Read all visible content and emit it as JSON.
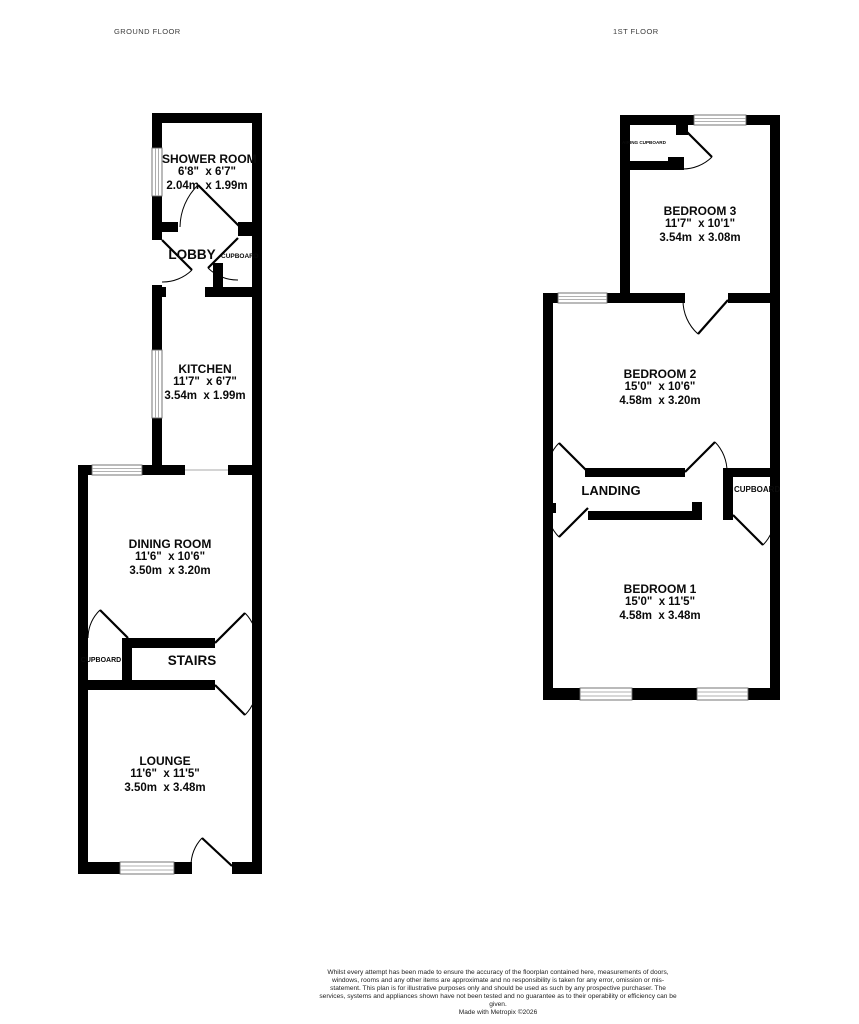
{
  "floors": [
    {
      "label": "GROUND FLOOR",
      "rooms": {
        "shower": {
          "name": "SHOWER ROOM",
          "imperial": "6'8\"  x 6'7\"",
          "metric": "2.04m  x 1.99m"
        },
        "lobby": {
          "label": "LOBBY"
        },
        "lobby_cupboard": {
          "label": "CUPBOARD"
        },
        "kitchen": {
          "name": "KITCHEN",
          "imperial": "11'7\"  x 6'7\"",
          "metric": "3.54m  x 1.99m"
        },
        "dining": {
          "name": "DINING ROOM",
          "imperial": "11'6\"  x 10'6\"",
          "metric": "3.50m  x 3.20m"
        },
        "stairs_cupboard": {
          "label": "CUPBOARD"
        },
        "stairs": {
          "label": "STAIRS"
        },
        "lounge": {
          "name": "LOUNGE",
          "imperial": "11'6\"  x 11'5\"",
          "metric": "3.50m  x 3.48m"
        }
      }
    },
    {
      "label": "1ST FLOOR",
      "rooms": {
        "airing_cupboard": {
          "label": "AIRING CUPBOARD"
        },
        "bedroom3": {
          "name": "BEDROOM 3",
          "imperial": "11'7\"  x 10'1\"",
          "metric": "3.54m  x 3.08m"
        },
        "bedroom2": {
          "name": "BEDROOM 2",
          "imperial": "15'0\"  x 10'6\"",
          "metric": "4.58m  x 3.20m"
        },
        "landing": {
          "label": "LANDING"
        },
        "cupboard": {
          "label": "CUPBOARD"
        },
        "bedroom1": {
          "name": "BEDROOM 1",
          "imperial": "15'0\"  x 11'5\"",
          "metric": "4.58m  x 3.48m"
        }
      }
    }
  ],
  "footer": {
    "disclaimer": "Whilst every attempt has been made to ensure the accuracy of the floorplan contained here, measurements of doors, windows, rooms and any other items are approximate and no responsibility is taken for any error, omission or mis-statement. This plan is for illustrative purposes only and should be used as such by any prospective purchaser. The services, systems and appliances shown have not been tested and no guarantee as to their operability or efficiency can be given.",
    "credit": "Made with Metropix ©2026"
  },
  "colors": {
    "wall": "#000000",
    "window_frame": "#666666",
    "text": "#0a0a0a"
  }
}
